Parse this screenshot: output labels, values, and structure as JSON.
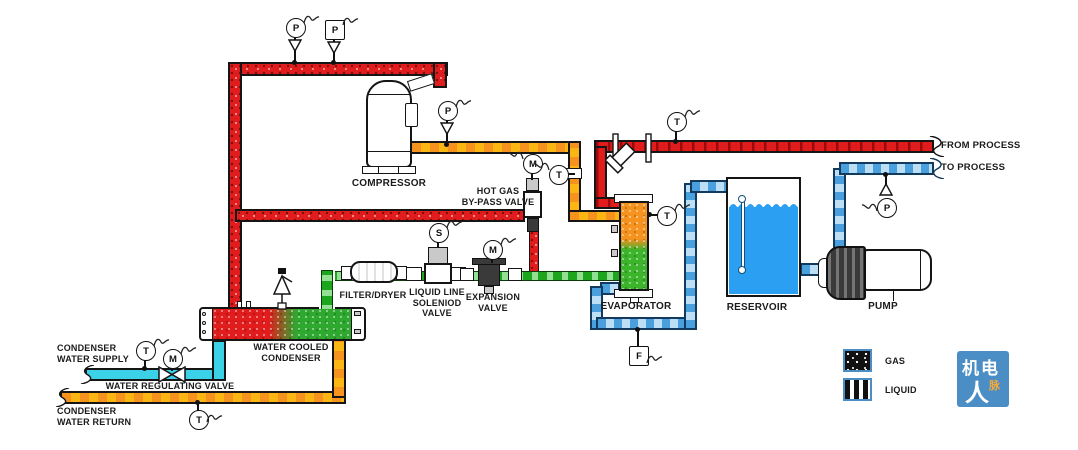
{
  "labels": {
    "compressor": "COMPRESSOR",
    "hot_gas_1": "HOT GAS",
    "hot_gas_2": "BY-PASS VALVE",
    "filter_dryer": "FILTER/DRYER",
    "solenoid_1": "LIQUID LINE",
    "solenoid_2": "SOLENIOD",
    "solenoid_3": "VALVE",
    "expansion_1": "EXPANSION",
    "expansion_2": "VALVE",
    "evaporator": "EVAPORATOR",
    "reservoir": "RESERVOIR",
    "pump": "PUMP",
    "from_process": "FROM PROCESS",
    "to_process": "TO PROCESS",
    "condenser_1": "WATER COOLED",
    "condenser_2": "CONDENSER",
    "water_supply_1": "CONDENSER",
    "water_supply_2": "WATER SUPPLY",
    "water_reg": "WATER REGULATING VALVE",
    "water_return_1": "CONDENSER",
    "water_return_2": "WATER RETURN"
  },
  "instruments": [
    {
      "id": "pressure-top-1",
      "letter": "P",
      "shape": "circle"
    },
    {
      "id": "pressure-top-2",
      "letter": "P",
      "shape": "square"
    },
    {
      "id": "pressure-discharge",
      "letter": "P",
      "shape": "circle"
    },
    {
      "id": "temp-suction",
      "letter": "T",
      "shape": "circle"
    },
    {
      "id": "motor-hot-gas-bypass",
      "letter": "M",
      "shape": "circle"
    },
    {
      "id": "solenoid-coil",
      "letter": "S",
      "shape": "circle"
    },
    {
      "id": "motor-expansion",
      "letter": "M",
      "shape": "circle"
    },
    {
      "id": "temp-from-process",
      "letter": "T",
      "shape": "circle"
    },
    {
      "id": "temp-evaporator",
      "letter": "T",
      "shape": "circle"
    },
    {
      "id": "pressure-to-process",
      "letter": "P",
      "shape": "circle"
    },
    {
      "id": "flow-chilled-water",
      "letter": "F",
      "shape": "square"
    },
    {
      "id": "temp-water-supply",
      "letter": "T",
      "shape": "circle"
    },
    {
      "id": "motor-water-regulating",
      "letter": "M",
      "shape": "circle"
    },
    {
      "id": "temp-water-return",
      "letter": "T",
      "shape": "circle"
    }
  ],
  "legend": {
    "items": [
      {
        "label": "GAS",
        "pattern": "speckle-on-black"
      },
      {
        "label": "LIQUID",
        "pattern": "white-stripes-on-black"
      }
    ]
  },
  "logo": {
    "line1": "机电",
    "line2": "人",
    "accent": "脉",
    "bg": "#4b8ec5"
  },
  "colors": {
    "gas_red": "#e11c1c",
    "hot_gas_orange": "#f6921e",
    "liquid_green": "#2fae2f",
    "chilled_blue": "#4aa0dc",
    "supply_cyan": "#3bd2e8",
    "reservoir_blue": "#2b9ff2"
  }
}
